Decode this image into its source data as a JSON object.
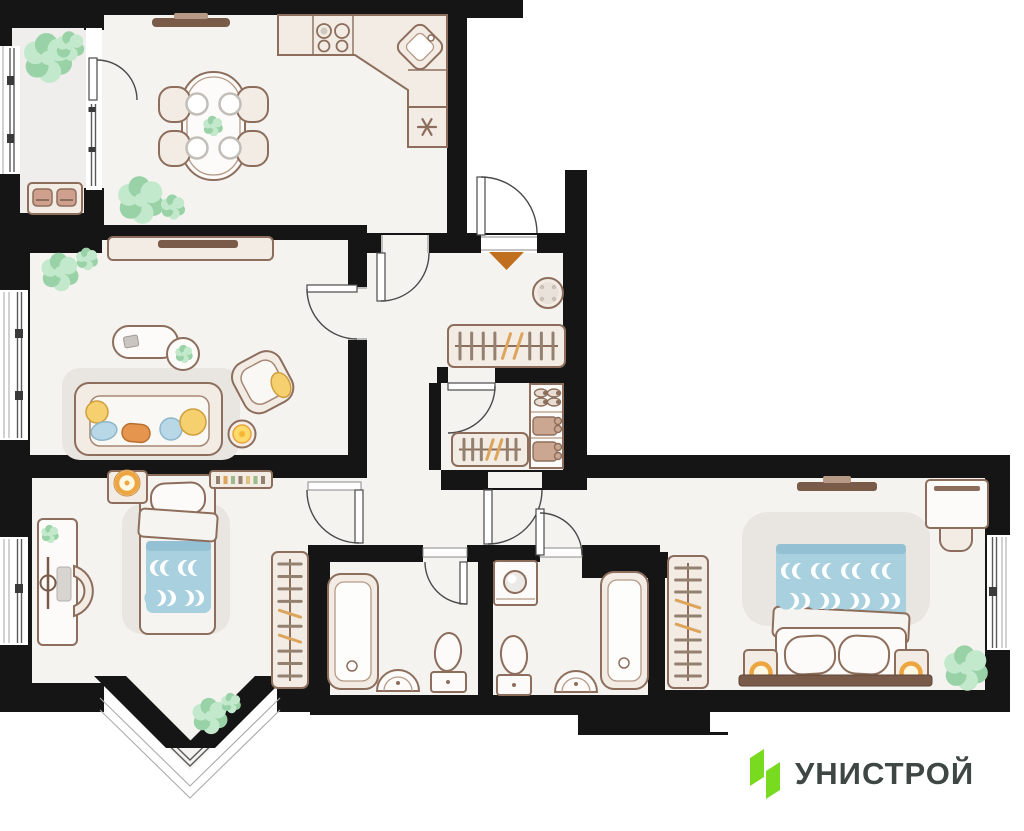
{
  "logo": {
    "text": "УНИСТРОЙ",
    "mark": "unistroy-logo-mark"
  },
  "colors": {
    "wall": "#151515",
    "floor": "#f4f3f0",
    "floor_alt": "#efeeec",
    "outside": "#ffffff",
    "outline": "#8d6e5c",
    "furniture": "#f2ece5",
    "furniture_white": "#fcfbf9",
    "mat": "#e9e6e1",
    "blanket": "#a9d0de",
    "blanket_dark": "#93c0d2",
    "accent_orange": "#bf6f1e",
    "lamp_ring": "#eda53f",
    "lamp_fill": "#fff8e3",
    "pillow_yellow": "#f6cf6f",
    "pillow_blue": "#b8d8e8",
    "pillow_orange": "#e6954e",
    "plant": "#a9dab4",
    "plant_light": "#c3e9cc",
    "plant_dark": "#9ad2a7",
    "hanger": "#94806f",
    "hanger_accent": "#dda45c",
    "tv": "#7a5b49",
    "door_line": "#4a4a4a",
    "glass": "#5a5a5a",
    "logo_green": "#79db20",
    "logo_text": "#3e4743"
  },
  "plan": {
    "rooms": [
      {
        "id": "balcony",
        "furniture": [
          "bench",
          "plants",
          "glazed-windows"
        ]
      },
      {
        "id": "kitchen-dining",
        "furniture": [
          "dining-table",
          "chairs-4",
          "plates-4",
          "stove-4-burner",
          "corner-sink",
          "fridge",
          "counter",
          "wall-tv",
          "plants"
        ]
      },
      {
        "id": "living-room",
        "furniture": [
          "tv-console",
          "tv",
          "sofa",
          "pillows",
          "armchair",
          "coffee-table",
          "side-table",
          "floor-lamp",
          "rug",
          "plants"
        ]
      },
      {
        "id": "entry-hallway",
        "furniture": [
          "entrance-door",
          "entrance-marker",
          "stool",
          "coat-rack"
        ]
      },
      {
        "id": "walk-in-closet",
        "furniture": [
          "hanger-rack",
          "shoe-shelf",
          "folded-clothes"
        ]
      },
      {
        "id": "corridor",
        "furniture": []
      },
      {
        "id": "bedroom",
        "furniture": [
          "bed",
          "pillow",
          "blanket",
          "nightstand",
          "lamp",
          "wall-shelf",
          "desk",
          "desk-chair",
          "laptop",
          "desk-lamp",
          "wardrobe-rack",
          "bay-window",
          "plants"
        ]
      },
      {
        "id": "bathroom-1",
        "furniture": [
          "bathtub",
          "sink",
          "toilet"
        ]
      },
      {
        "id": "bathroom-2",
        "furniture": [
          "washing-machine",
          "toilet",
          "sink",
          "bathtub"
        ]
      },
      {
        "id": "master-bedroom",
        "furniture": [
          "double-bed",
          "pillows-2",
          "nightstands-2",
          "lamps-2",
          "wall-tv",
          "desk",
          "chair",
          "wardrobe-rack",
          "plant",
          "window"
        ]
      }
    ]
  },
  "decor": {
    "racks": [
      {
        "name": "hall-coat-rack",
        "x": 448,
        "y": 325,
        "w": 117,
        "h": 42,
        "dir": "h",
        "count": 9,
        "accents": [
          4,
          5
        ]
      },
      {
        "name": "closet-hanger-rack",
        "x": 452,
        "y": 433,
        "w": 76,
        "h": 33,
        "dir": "h",
        "count": 7,
        "accents": [
          3,
          4
        ]
      },
      {
        "name": "bedroom-wardrobe-rack",
        "x": 272,
        "y": 552,
        "w": 36,
        "h": 136,
        "dir": "v",
        "count": 10,
        "accents": [
          4,
          6
        ]
      },
      {
        "name": "master-wardrobe-rack",
        "x": 668,
        "y": 556,
        "w": 40,
        "h": 132,
        "dir": "v",
        "count": 10,
        "accents": [
          3,
          5
        ]
      }
    ],
    "beds": [
      {
        "name": "bedroom-bed-moons",
        "r": 8,
        "rows": [
          {
            "cy": 568,
            "dir": 1,
            "xs": [
              158,
              168,
              186,
              196
            ]
          },
          {
            "cy": 598,
            "dir": -1,
            "xs": [
              158,
              168,
              186,
              196
            ]
          }
        ]
      },
      {
        "name": "master-bed-moons",
        "r": 8,
        "rows": [
          {
            "cy": 571,
            "dir": 1,
            "xs": [
              789,
              800,
              819,
              830,
              849,
              860,
              879,
              890
            ]
          },
          {
            "cy": 601,
            "dir": -1,
            "xs": [
              791,
              802,
              821,
              832,
              851,
              862,
              881,
              892
            ]
          }
        ]
      }
    ],
    "plants": [
      {
        "name": "balcony-plant",
        "cx": 48,
        "cy": 58,
        "r": 22
      },
      {
        "name": "balcony-plant-2",
        "cx": 70,
        "cy": 46,
        "r": 13
      },
      {
        "name": "kitchen-plant",
        "cx": 141,
        "cy": 200,
        "r": 21
      },
      {
        "name": "kitchen-plant-2",
        "cx": 173,
        "cy": 207,
        "r": 11
      },
      {
        "name": "dining-table-plant",
        "cx": 213,
        "cy": 126,
        "r": 9
      },
      {
        "name": "living-plant",
        "cx": 60,
        "cy": 272,
        "r": 17
      },
      {
        "name": "living-plant-2",
        "cx": 87,
        "cy": 259,
        "r": 10
      },
      {
        "name": "side-table-plant",
        "cx": 184,
        "cy": 354,
        "r": 8
      },
      {
        "name": "desk-plant",
        "cx": 50,
        "cy": 534,
        "r": 8
      },
      {
        "name": "bay-plant",
        "cx": 210,
        "cy": 716,
        "r": 16
      },
      {
        "name": "bay-plant-2",
        "cx": 231,
        "cy": 703,
        "r": 9
      },
      {
        "name": "master-plant",
        "cx": 966,
        "cy": 668,
        "r": 20
      }
    ]
  }
}
